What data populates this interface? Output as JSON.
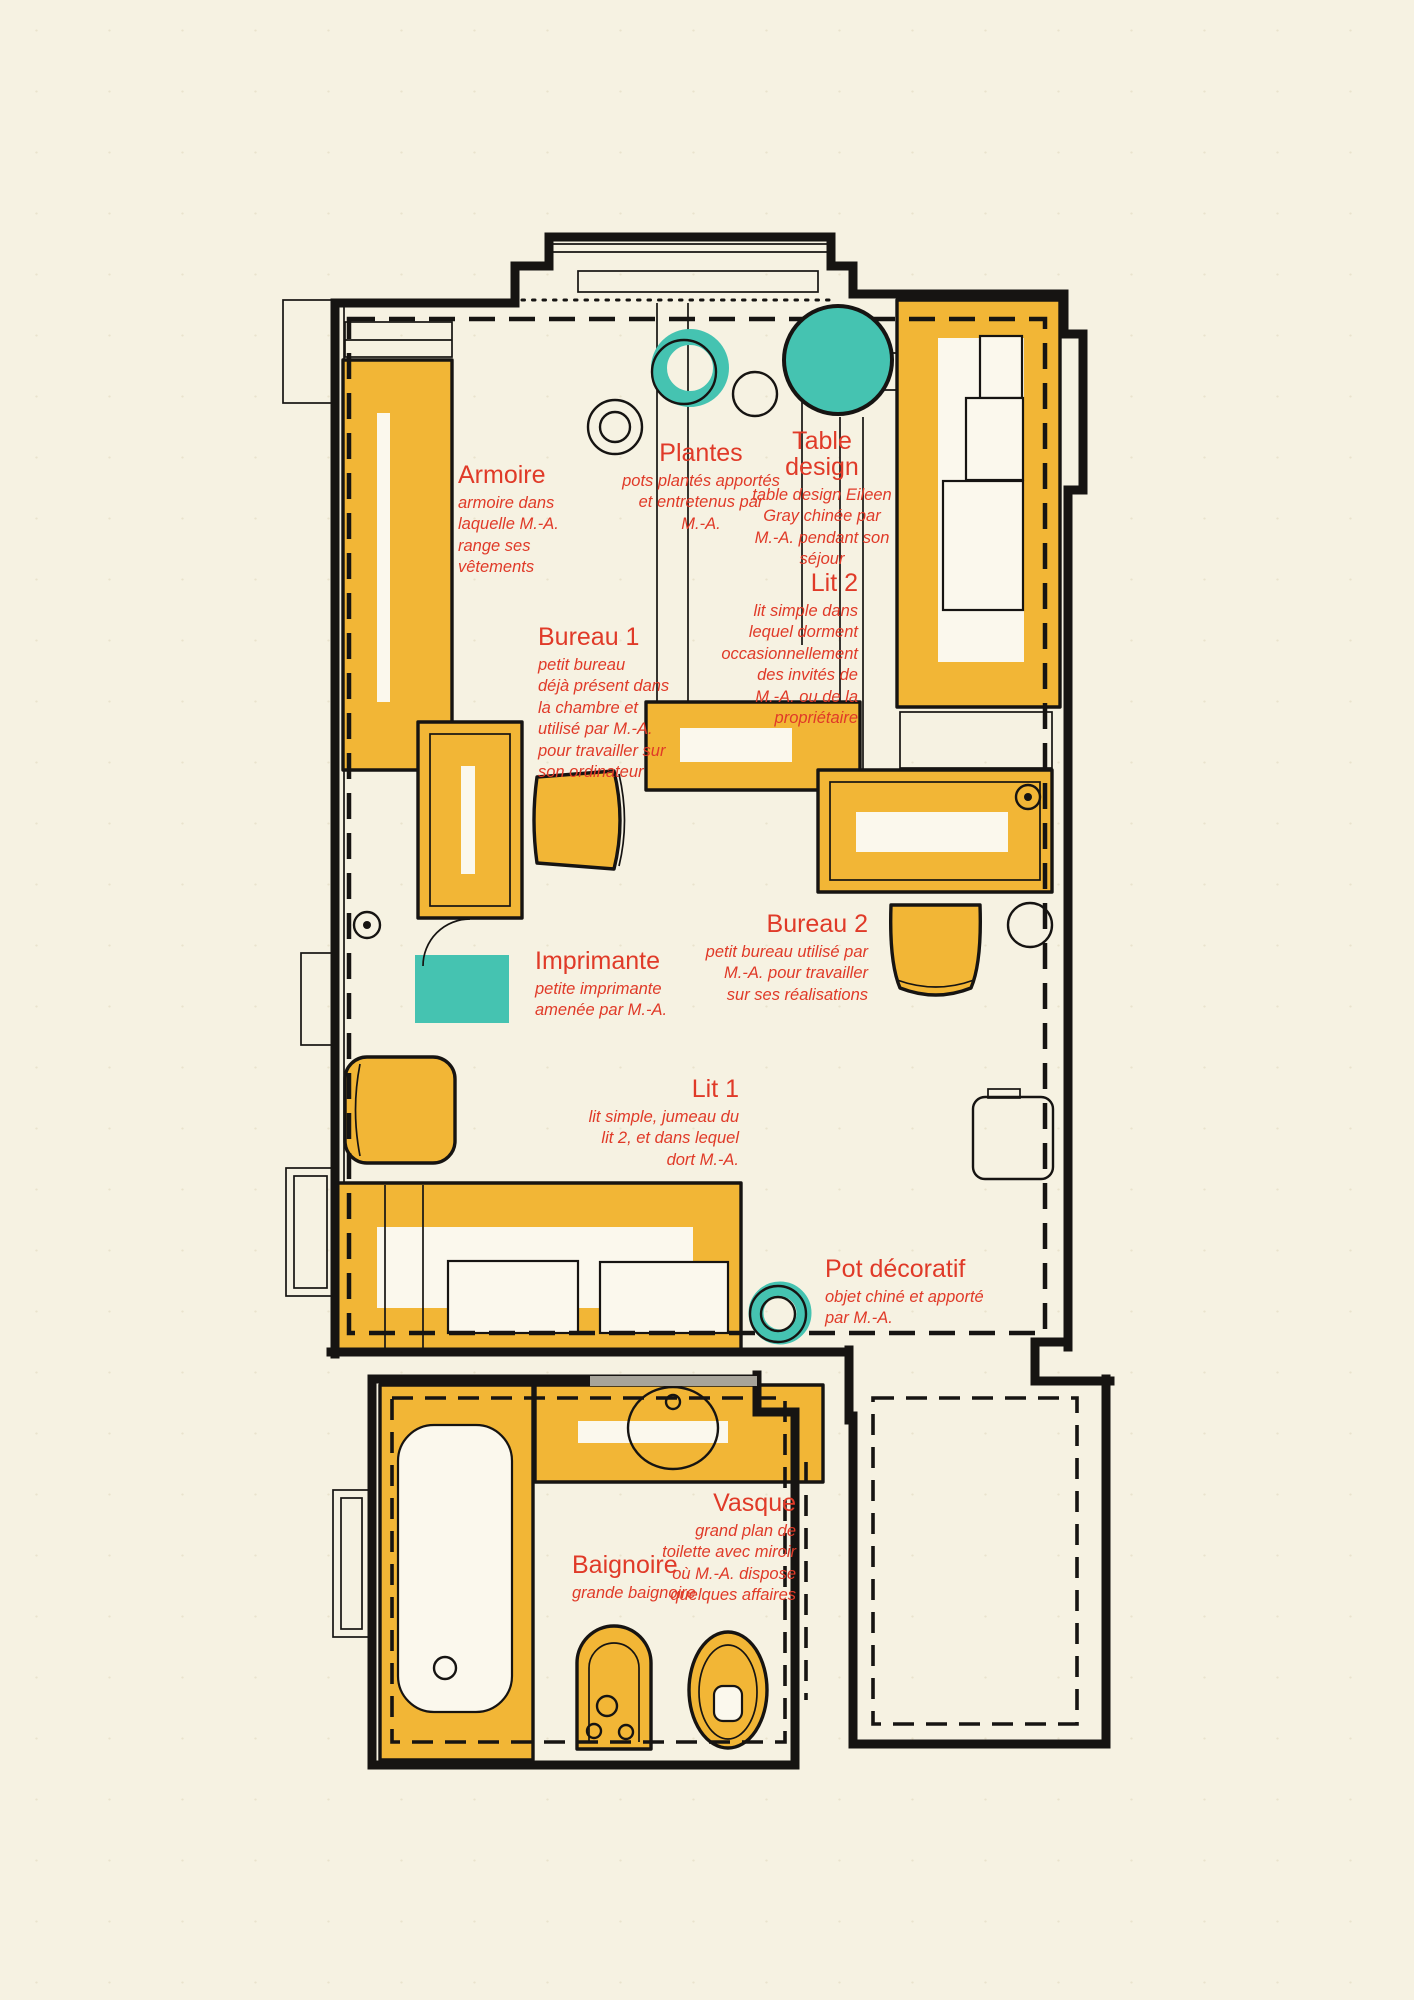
{
  "meta": {
    "type": "floor-plan",
    "language": "fr"
  },
  "colors": {
    "paper": "#f6f2e2",
    "white": "#fbf8ed",
    "ink": "#161412",
    "red": "#e03a28",
    "yellow": "#f2b636",
    "teal": "#45c3b1",
    "gray": "#a7a49a"
  },
  "labels": {
    "armoire": {
      "title": "Armoire",
      "desc": "armoire dans\nlaquelle M.-A.\nrange ses\nvêtements"
    },
    "plantes": {
      "title": "Plantes",
      "desc": "pots plantés apportés\net entretenus par\nM.-A."
    },
    "table_design": {
      "title": "Table\ndesign",
      "desc": "table design Eileen\nGray chinée par\nM.-A. pendant son\nséjour"
    },
    "lit2": {
      "title": "Lit 2",
      "desc": "lit simple dans\nlequel dorment\noccasionnellement\ndes invités de\nM.-A. ou de la\npropriétaire"
    },
    "bureau1": {
      "title": "Bureau 1",
      "desc": "petit bureau\ndéjà présent dans\nla chambre et\nutilisé par M.-A.\npour travailler sur\nson ordinateur"
    },
    "bureau2": {
      "title": "Bureau 2",
      "desc": "petit bureau utilisé par\nM.-A. pour travailler\nsur ses réalisations"
    },
    "imprimante": {
      "title": "Imprimante",
      "desc": "petite imprimante\namenée par M.-A."
    },
    "lit1": {
      "title": "Lit 1",
      "desc": "lit simple, jumeau du\nlit 2, et dans lequel\ndort M.-A."
    },
    "pot_decoratif": {
      "title": "Pot décoratif",
      "desc": "objet chiné et apporté\npar M.-A."
    },
    "vasque": {
      "title": "Vasque",
      "desc": "grand plan de\ntoilette avec miroir\noù M.-A. dispose\nquelques affaires"
    },
    "baignoire": {
      "title": "Baignoire",
      "desc": "grande baignoire"
    }
  }
}
